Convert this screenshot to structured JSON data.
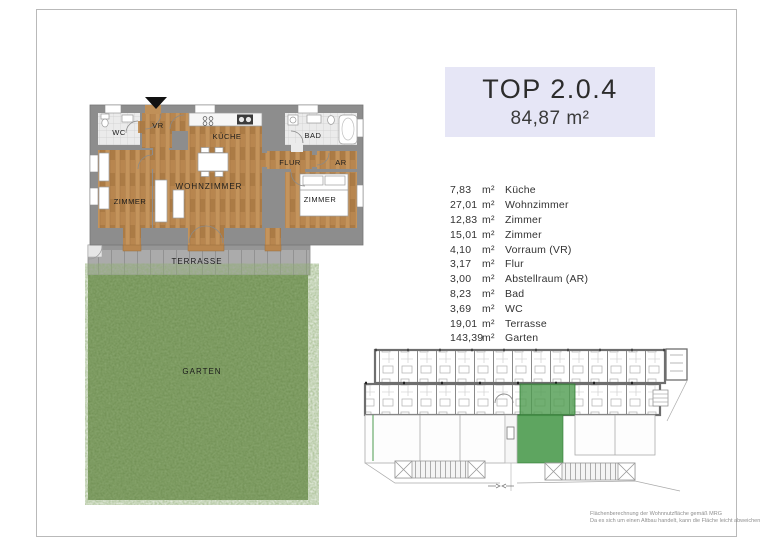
{
  "title_box": {
    "title": "TOP 2.0.4",
    "area": "84,87 m²"
  },
  "floorplan": {
    "labels": {
      "wc": "WC",
      "vr": "VR",
      "kueche": "KÜCHE",
      "bad": "BAD",
      "flur": "FLUR",
      "ar": "AR",
      "zimmer_left": "ZIMMER",
      "wohnzimmer": "WOHNZIMMER",
      "zimmer_right": "ZIMMER",
      "terrasse": "TERRASSE",
      "garten": "GARTEN"
    }
  },
  "room_list": {
    "rows": [
      {
        "area": "7,83",
        "unit": "m²",
        "name": "Küche"
      },
      {
        "area": "27,01",
        "unit": "m²",
        "name": "Wohnzimmer"
      },
      {
        "area": "12,83",
        "unit": "m²",
        "name": "Zimmer"
      },
      {
        "area": "15,01",
        "unit": "m²",
        "name": "Zimmer"
      },
      {
        "area": "4,10",
        "unit": "m²",
        "name": "Vorraum (VR)"
      },
      {
        "area": "3,17",
        "unit": "m²",
        "name": "Flur"
      },
      {
        "area": "3,00",
        "unit": "m²",
        "name": "Abstellraum (AR)"
      },
      {
        "area": "8,23",
        "unit": "m²",
        "name": "Bad"
      },
      {
        "area": "3,69",
        "unit": "m²",
        "name": "WC"
      },
      {
        "area": "19,01",
        "unit": "m²",
        "name": "Terrasse"
      },
      {
        "area": "143,39",
        "unit": "m²",
        "name": "Garten"
      }
    ]
  },
  "footnote": {
    "line1": "Flächenberechnung der Wohnnutzfläche gemäß MRG",
    "line2": "Da es sich um einen Altbau handelt, kann die Fläche leicht abweichen"
  },
  "colors": {
    "title_box_bg": "#e6e6f6",
    "highlight_green": "#4d9b4f",
    "wood_floor": "#b8864f",
    "grass_green": "#5f8743",
    "wall_gray": "#8d8d8d",
    "terrace_gray": "#ababab"
  }
}
